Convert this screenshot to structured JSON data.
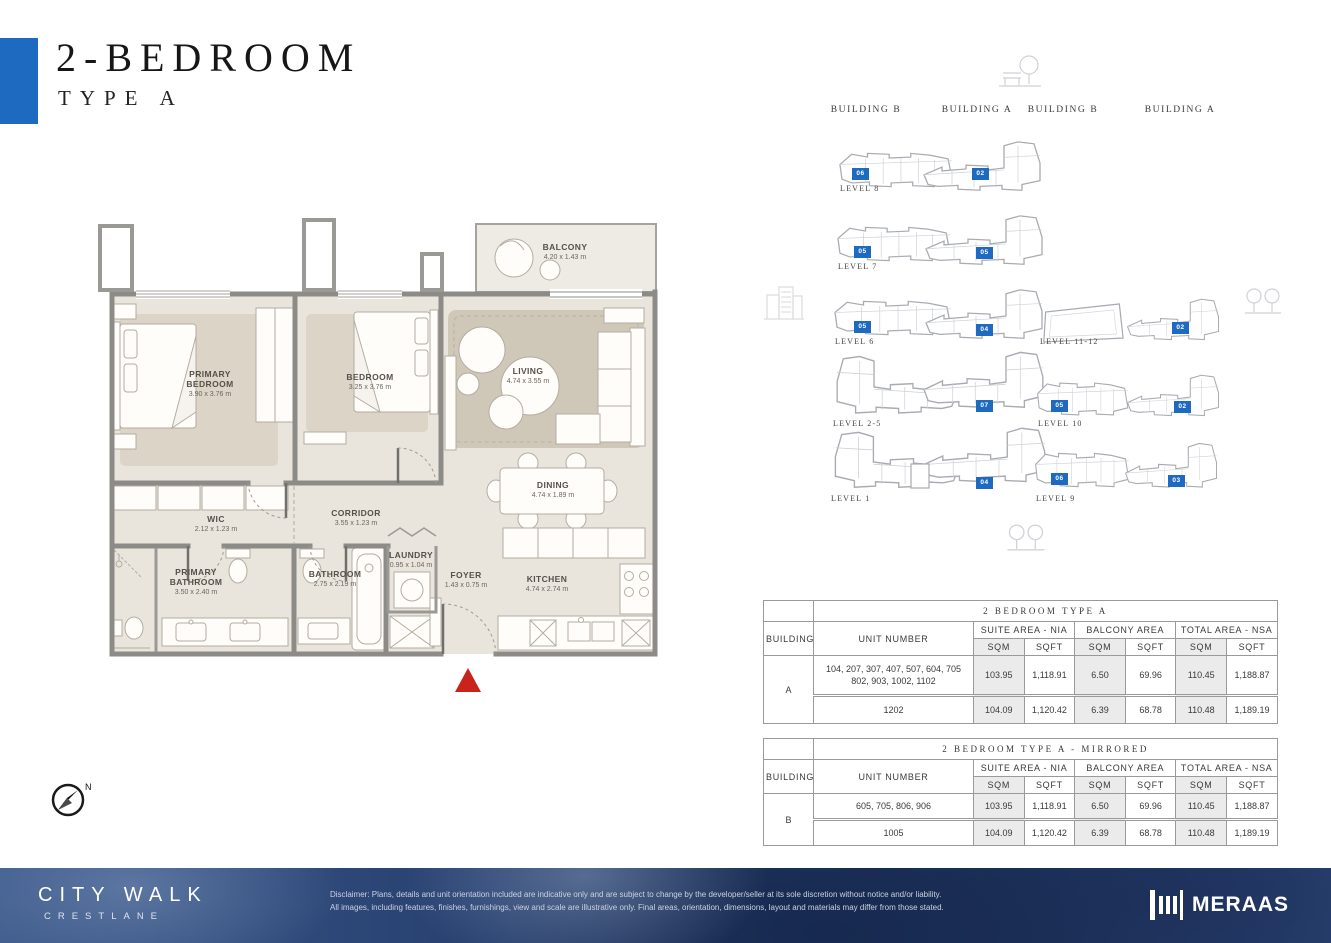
{
  "page": {
    "title": "2-BEDROOM",
    "subtitle": "TYPE A"
  },
  "colors": {
    "accent": "#1e6ac1",
    "wall": "#8d8b88",
    "footer_navy": "#20355f",
    "entry_marker_red": "#c9241c"
  },
  "floor_plan": {
    "compass_label": "N",
    "rooms": [
      {
        "name": "BALCONY",
        "dims": "4.20 x 1.43 m"
      },
      {
        "name": "PRIMARY\nBEDROOM",
        "dims": "3.90 x 3.76 m"
      },
      {
        "name": "BEDROOM",
        "dims": "3.25 x 3.76 m"
      },
      {
        "name": "LIVING",
        "dims": "4.74 x 3.55 m"
      },
      {
        "name": "DINING",
        "dims": "4.74 x 1.89 m"
      },
      {
        "name": "WIC",
        "dims": "2.12 x 1.23 m"
      },
      {
        "name": "CORRIDOR",
        "dims": "3.55 x 1.23 m"
      },
      {
        "name": "PRIMARY\nBATHROOM",
        "dims": "3.50 x 2.40 m"
      },
      {
        "name": "BATHROOM",
        "dims": "2.75 x 2.19 m"
      },
      {
        "name": "LAUNDRY",
        "dims": "0.95 x 1.04 m"
      },
      {
        "name": "FOYER",
        "dims": "1.43 x 0.75 m"
      },
      {
        "name": "KITCHEN",
        "dims": "4.74 x 2.74 m"
      }
    ]
  },
  "key_plan": {
    "column_headers": [
      "BUILDING B",
      "BUILDING A",
      "BUILDING B",
      "BUILDING A"
    ],
    "rows": [
      {
        "level": "LEVEL 8",
        "b_unit": "06",
        "a_unit": "02"
      },
      {
        "level": "LEVEL 7",
        "b_unit": "05",
        "a_unit": "05"
      },
      {
        "level": "LEVEL 6",
        "b_unit": "05",
        "a_unit": "04"
      },
      {
        "level": "LEVEL 2-5",
        "b_unit": "",
        "a_unit": "07"
      },
      {
        "level": "LEVEL 1",
        "b_unit": "",
        "a_unit": "04"
      },
      {
        "level": "LEVEL 11-12",
        "b_unit": "",
        "a_unit": "02"
      },
      {
        "level": "LEVEL 10",
        "b_unit": "05",
        "a_unit": "02"
      },
      {
        "level": "LEVEL 9",
        "b_unit": "06",
        "a_unit": "03"
      }
    ]
  },
  "tables": [
    {
      "title": "2 BEDROOM TYPE A",
      "building_header": "BUILDING",
      "unit_header": "UNIT NUMBER",
      "group_headers": [
        "SUITE AREA - NIA",
        "BALCONY AREA",
        "TOTAL AREA - NSA"
      ],
      "sub_headers": [
        "SQM",
        "SQFT",
        "SQM",
        "SQFT",
        "SQM",
        "SQFT"
      ],
      "building": "A",
      "rows": [
        {
          "units": "104, 207, 307, 407, 507, 604, 705\n802, 903, 1002, 1102",
          "values": [
            "103.95",
            "1,118.91",
            "6.50",
            "69.96",
            "110.45",
            "1,188.87"
          ]
        },
        {
          "units": "1202",
          "values": [
            "104.09",
            "1,120.42",
            "6.39",
            "68.78",
            "110.48",
            "1,189.19"
          ]
        }
      ]
    },
    {
      "title": "2 BEDROOM TYPE A - MIRRORED",
      "building_header": "BUILDING",
      "unit_header": "UNIT NUMBER",
      "group_headers": [
        "SUITE AREA - NIA",
        "BALCONY AREA",
        "TOTAL AREA - NSA"
      ],
      "sub_headers": [
        "SQM",
        "SQFT",
        "SQM",
        "SQFT",
        "SQM",
        "SQFT"
      ],
      "building": "B",
      "rows": [
        {
          "units": "605, 705, 806, 906",
          "values": [
            "103.95",
            "1,118.91",
            "6.50",
            "69.96",
            "110.45",
            "1,188.87"
          ]
        },
        {
          "units": "1005",
          "values": [
            "104.09",
            "1,120.42",
            "6.39",
            "68.78",
            "110.48",
            "1,189.19"
          ]
        }
      ]
    }
  ],
  "footer": {
    "brand_line1": "CITY WALK",
    "brand_line2": "CRESTLANE",
    "disclaimer_line1": "Disclaimer: Plans, details and unit orientation included are indicative only and are subject to change by the developer/seller at its sole discretion without notice and/or liability.",
    "disclaimer_line2": "All images, including features, finishes, furnishings, view and scale are illustrative only. Final areas, orientation, dimensions, layout and materials may differ from those stated.",
    "brand_logo": "MERAAS"
  }
}
